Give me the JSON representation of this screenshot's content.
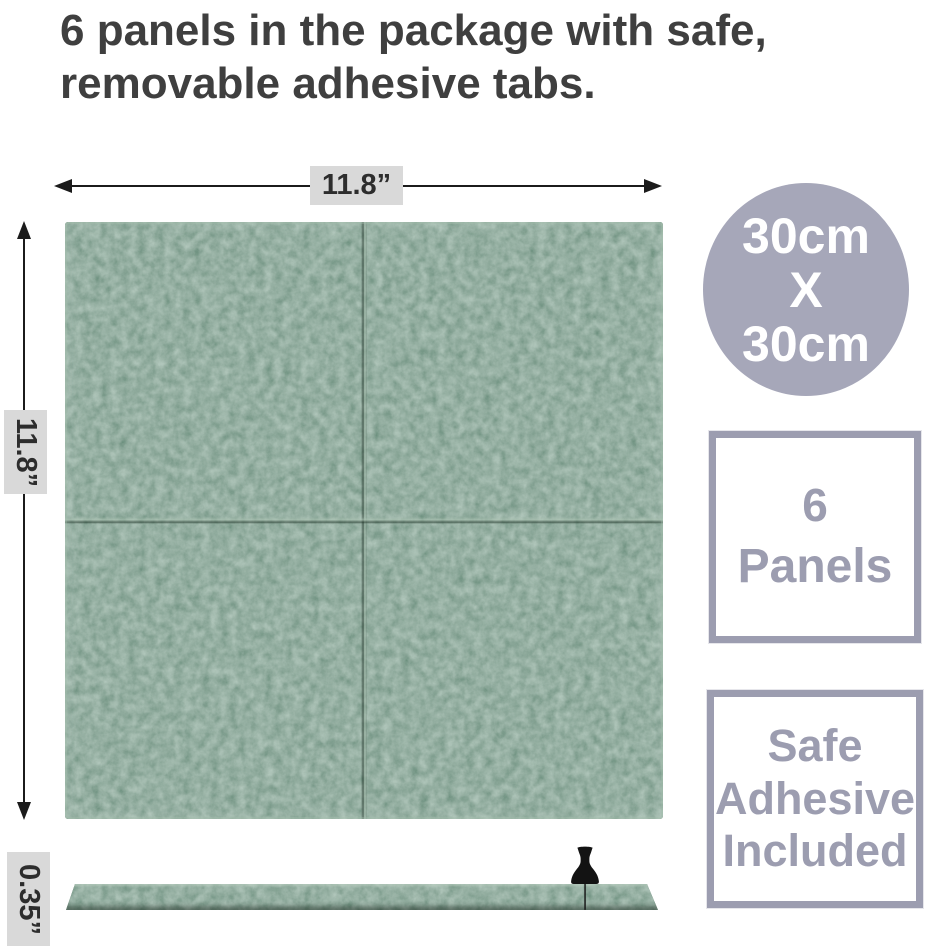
{
  "title": {
    "line1": "6 panels in the package with safe,",
    "line2": "removable adhesive tabs."
  },
  "dimensions": {
    "width": "11.8”",
    "height": "11.8”",
    "thickness": "0.35”"
  },
  "size_badge": {
    "line1": "30cm",
    "line2": "X",
    "line3": "30cm"
  },
  "panels_badge": {
    "value": "6",
    "label": "Panels"
  },
  "adhesive_badge": {
    "line1": "Safe",
    "line2": "Adhesive",
    "line3": "Included"
  },
  "colors": {
    "title_text": "#3f3f3f",
    "arrow": "#1b1b1b",
    "label_bg": "#d9d9d9",
    "label_text": "#2d2d2d",
    "badge_fill": "#a6a7b9",
    "badge_text": "#ffffff",
    "box_border": "#9c9db0",
    "box_text": "#9c9db0",
    "felt_base": "#466853"
  }
}
